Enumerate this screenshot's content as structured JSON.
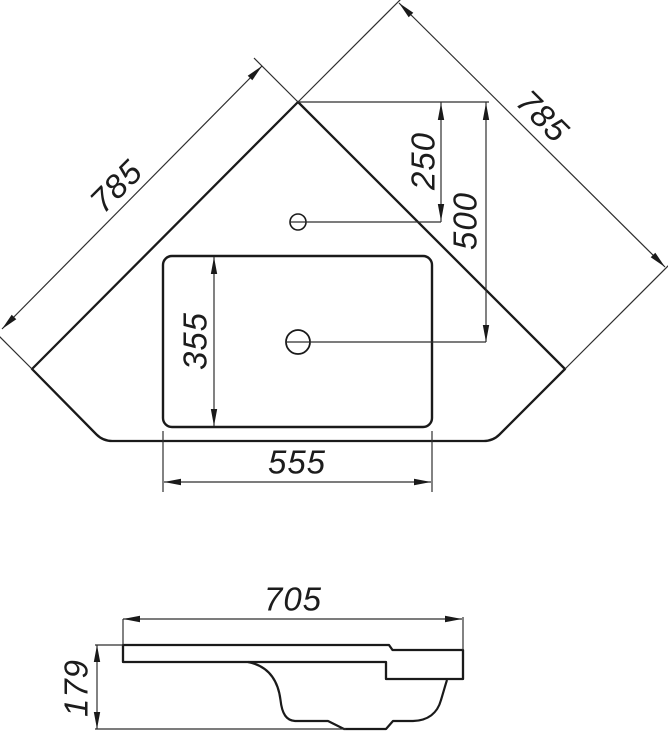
{
  "drawing": {
    "top_view": {
      "dim_edge_left": "785",
      "dim_edge_right": "785",
      "dim_faucet_from_corner": "250",
      "dim_drain_from_corner": "500",
      "dim_basin_depth": "355",
      "dim_basin_width": "555"
    },
    "side_view": {
      "dim_overall_width": "705",
      "dim_overall_height": "179"
    },
    "colors": {
      "outline": "#1a1a1a",
      "dimension_line": "#2e2e2e",
      "background": "#ffffff"
    }
  }
}
